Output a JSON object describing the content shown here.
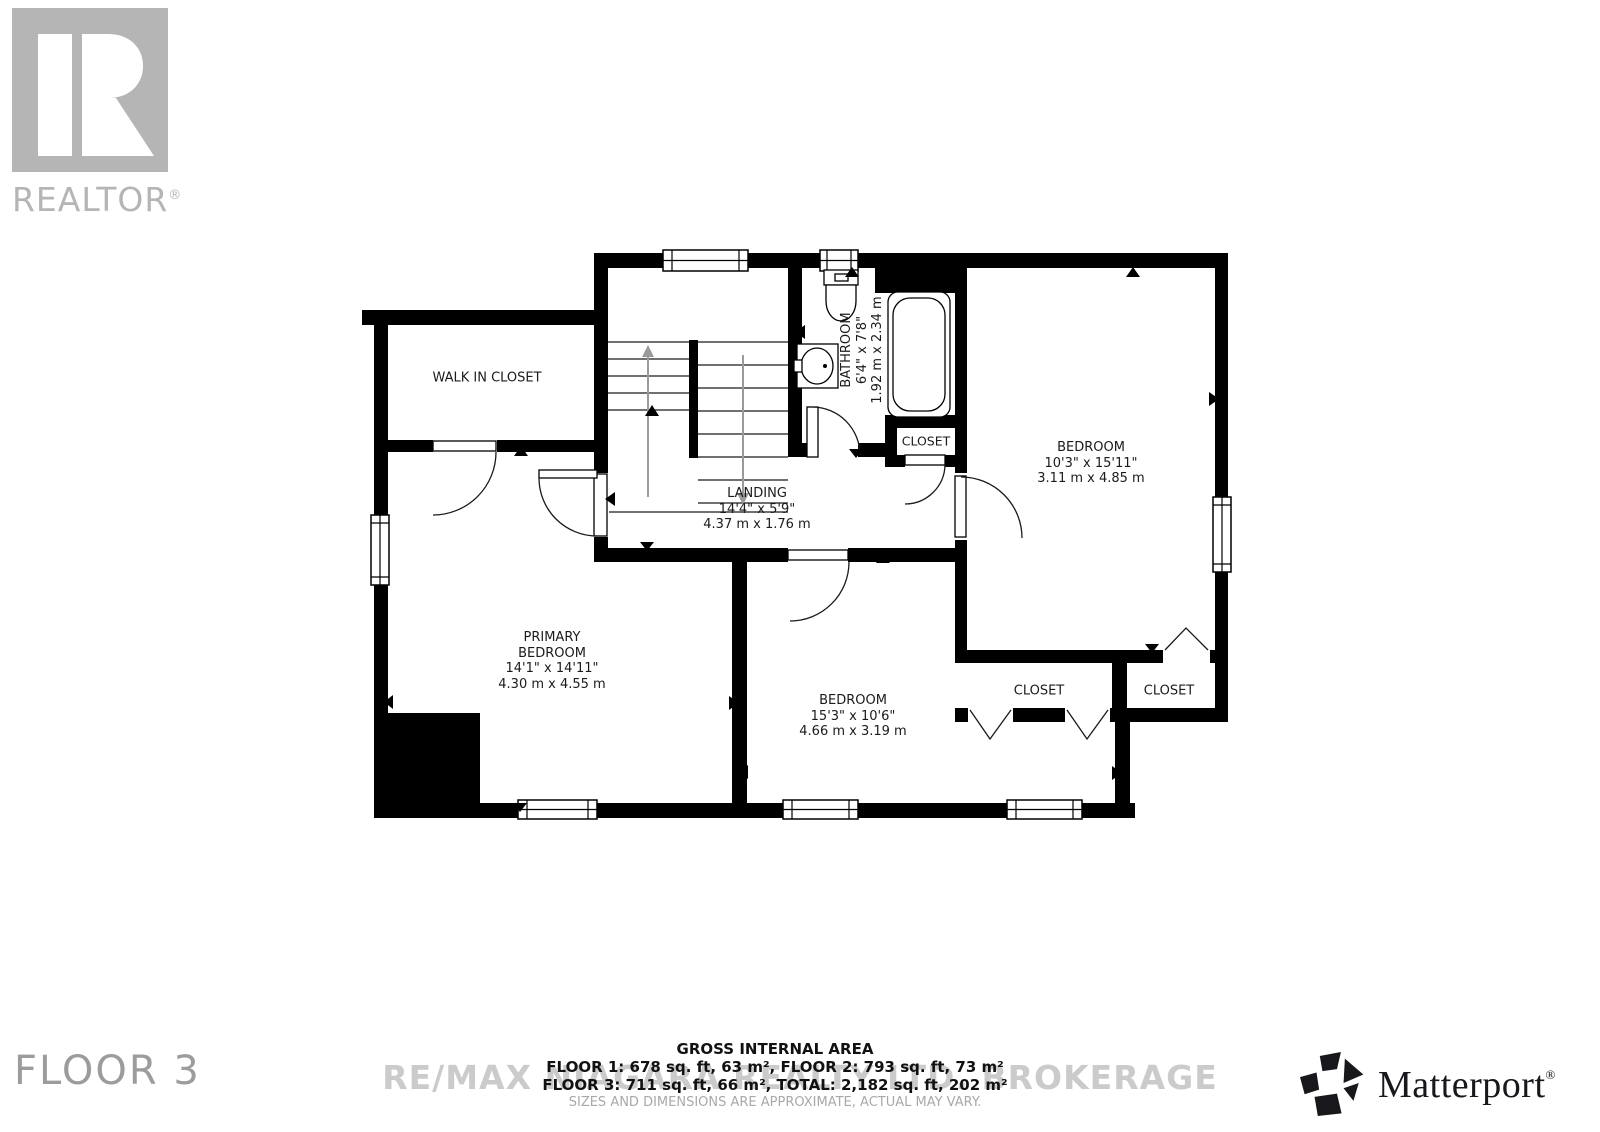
{
  "branding": {
    "realtor": {
      "wordmark": "REALTOR",
      "reg": "®"
    },
    "matterport": {
      "wordmark": "Matterport",
      "reg": "®"
    }
  },
  "floor": {
    "label": "FLOOR 3"
  },
  "watermark": {
    "text": "RE/MAX NIAGARA REALTY LTD. BROKERAGE"
  },
  "area_summary": {
    "title": "GROSS INTERNAL AREA",
    "line_1": "FLOOR 1: 678 sq. ft, 63 m², FLOOR 2: 793 sq. ft, 73 m²",
    "line_2": "FLOOR 3: 711 sq. ft, 66 m², TOTAL: 2,182 sq. ft, 202 m²",
    "disclaimer": "SIZES AND DIMENSIONS ARE APPROXIMATE, ACTUAL MAY VARY."
  },
  "rooms": {
    "walk_in_closet": {
      "name": "WALK IN CLOSET"
    },
    "bathroom": {
      "name": "BATHROOM",
      "imperial": "6'4\" x 7'8\"",
      "metric": "1.92 m x 2.34 m"
    },
    "landing": {
      "name": "LANDING",
      "imperial": "14'4\" x 5'9\"",
      "metric": "4.37 m x 1.76 m"
    },
    "bedroom_right": {
      "name": "BEDROOM",
      "imperial": "10'3\" x 15'11\"",
      "metric": "3.11 m x 4.85 m"
    },
    "primary_bedroom": {
      "name_line_1": "PRIMARY",
      "name_line_2": "BEDROOM",
      "imperial": "14'1\" x 14'11\"",
      "metric": "4.30 m x 4.55 m"
    },
    "bedroom_bottom": {
      "name": "BEDROOM",
      "imperial": "15'3\" x 10'6\"",
      "metric": "4.66 m x 3.19 m"
    },
    "closet_bathroom": {
      "name": "CLOSET"
    },
    "closet_left": {
      "name": "CLOSET"
    },
    "closet_right": {
      "name": "CLOSET"
    }
  }
}
